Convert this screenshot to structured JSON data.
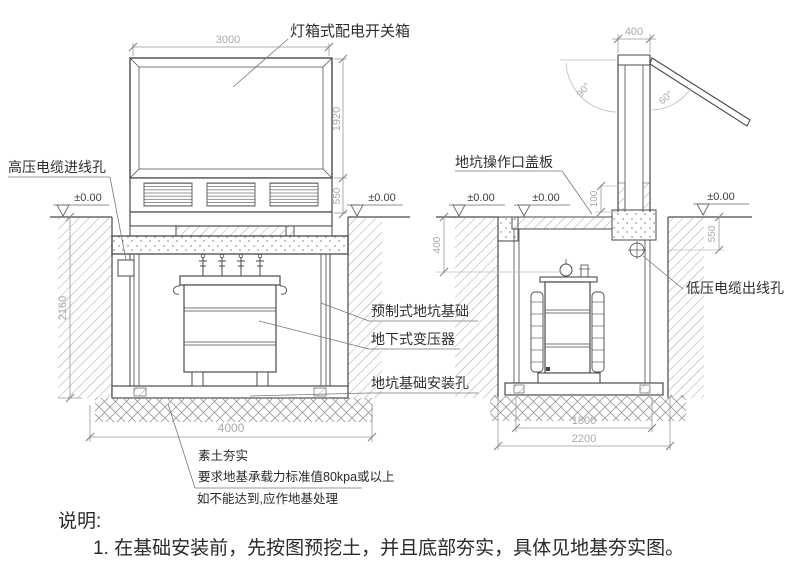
{
  "front_view": {
    "labels": {
      "light_box": "灯箱式配电开关箱",
      "hv_cable_hole": "高压电缆进线孔",
      "precast_pit_foundation": "预制式地坑基础",
      "underground_transformer": "地下式变压器",
      "pit_mounting_hole": "地坑基础安装孔"
    },
    "dims": {
      "width_top": "3000",
      "cabinet_height": "1920",
      "base_band": "550",
      "pit_depth": "2160",
      "pit_width": "4000"
    },
    "level": "±0.00"
  },
  "side_view": {
    "labels": {
      "pit_cover": "地坑操作口盖板",
      "lv_cable_hole": "低压电缆出线孔"
    },
    "dims": {
      "shaft_width": "400",
      "cover_offset": "100",
      "pit_top_depth": "400",
      "edge_depth": "550",
      "inner_width": "1800",
      "outer_width": "2200"
    },
    "angles": {
      "full_open": "90°",
      "partial_open": "60°"
    },
    "level": "±0.00"
  },
  "ground_note": {
    "line1": "素土夯实",
    "line2": "要求地基承载力标准值80kpa或以上",
    "line3": "如不能达到,应作地基处理"
  },
  "notes": {
    "heading": "说明:",
    "item1": "1. 在基础安装前，先按图预挖土，并且底部夯实，具体见地基夯实图。"
  },
  "colors": {
    "line": "#4a4a4a",
    "dim": "#999999",
    "hatch": "#9a9a9a"
  }
}
